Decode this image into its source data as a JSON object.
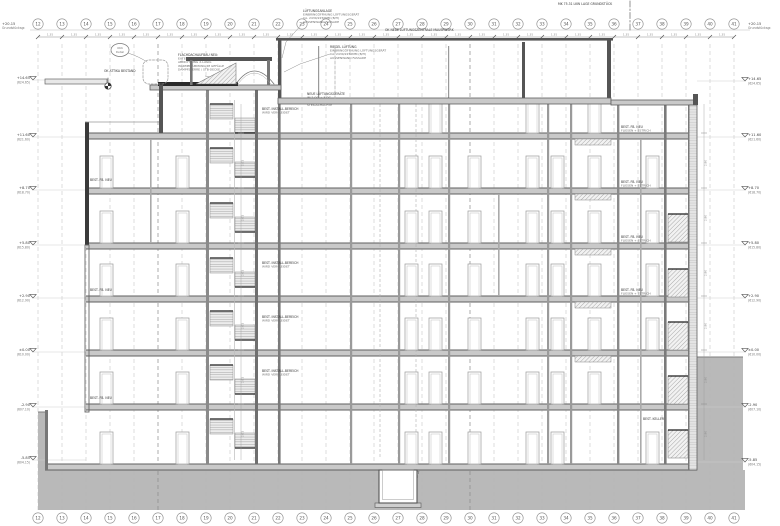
{
  "drawing": {
    "type": "architectural-section",
    "colors": {
      "background": "#ffffff",
      "ink": "#4a4a4a",
      "light_line": "#9a9a9a",
      "grid_dash": "#b6b6b6",
      "grid_dash_strong": "#8c8c8c",
      "slab_fill": "#c9c9c9",
      "slab_edge": "#5f5f5f",
      "ground_fill": "#b9b9b9",
      "dark_fill": "#2e2e2e"
    },
    "grid": {
      "axes": [
        "12",
        "13",
        "14",
        "15",
        "16",
        "17",
        "18",
        "19",
        "20",
        "21",
        "22",
        "23",
        "24",
        "25",
        "26",
        "27",
        "28",
        "29",
        "30",
        "31",
        "32",
        "33",
        "34",
        "35",
        "36",
        "37",
        "38",
        "39",
        "40",
        "41"
      ],
      "strong_axes": [
        "17",
        "30"
      ],
      "x_start": 38,
      "x_spacing": 24,
      "top_bubble_y": 24,
      "bottom_bubble_y": 518,
      "dim_line_y": 37,
      "bay_dim_label": "1.35"
    },
    "levels": {
      "left_x": 30,
      "right_x": 748,
      "left": [
        {
          "y": 80,
          "value": "+14.65",
          "abs": "(624.65)"
        },
        {
          "y": 137,
          "value": "+11.60",
          "abs": "(621.60)"
        },
        {
          "y": 190,
          "value": "+8.70",
          "abs": "(618.70)"
        },
        {
          "y": 245,
          "value": "+5.80",
          "abs": "(615.80)"
        },
        {
          "y": 298,
          "value": "+2.90",
          "abs": "(612.90)"
        },
        {
          "y": 352,
          "value": "±0.00",
          "abs": "(610.00)"
        },
        {
          "y": 407,
          "value": "-2.90",
          "abs": "(607.10)"
        },
        {
          "y": 460,
          "value": "-5.85",
          "abs": "(604.15)"
        }
      ],
      "right": [
        {
          "y": 81,
          "value": "+14.65",
          "abs": "(624.65)"
        },
        {
          "y": 137,
          "value": "+11.60",
          "abs": "(621.60)"
        },
        {
          "y": 190,
          "value": "+8.70",
          "abs": "(618.70)"
        },
        {
          "y": 245,
          "value": "+5.80",
          "abs": "(615.80)"
        },
        {
          "y": 298,
          "value": "+2.90",
          "abs": "(612.90)"
        },
        {
          "y": 352,
          "value": "±0.00",
          "abs": "(610.00)"
        },
        {
          "y": 407,
          "value": "-2.90",
          "abs": "(607.10)"
        },
        {
          "y": 462,
          "value": "-5.85",
          "abs": "(604.15)"
        }
      ],
      "top_left": {
        "y": 25,
        "value": "+20.15",
        "abs": "Grundstücksgr."
      },
      "top_right": {
        "y": 25,
        "value": "+20.15",
        "abs": "Grundstücksgr."
      }
    },
    "structure": {
      "slabs": [
        {
          "x": 86,
          "y": 133,
          "w": 611,
          "h": 6
        },
        {
          "x": 86,
          "y": 188,
          "w": 611,
          "h": 6
        },
        {
          "x": 86,
          "y": 243,
          "w": 611,
          "h": 6
        },
        {
          "x": 86,
          "y": 296,
          "w": 611,
          "h": 6
        },
        {
          "x": 86,
          "y": 350,
          "w": 611,
          "h": 6
        },
        {
          "x": 86,
          "y": 404,
          "w": 611,
          "h": 6
        },
        {
          "x": 45,
          "y": 464,
          "w": 652,
          "h": 6
        }
      ],
      "walls": [
        {
          "x": 150,
          "y1": 139,
          "y2": 243,
          "w": 1.6,
          "tone": "#aaaaaa"
        },
        {
          "x": 206,
          "y1": 90,
          "y2": 464,
          "w": 3,
          "tone": "#8a8a8a"
        },
        {
          "x": 234,
          "y1": 100,
          "y2": 460,
          "w": 0.7,
          "tone": "#bcbcbc"
        },
        {
          "x": 255,
          "y1": 90,
          "y2": 464,
          "w": 3,
          "tone": "#6f6f6f"
        },
        {
          "x": 278,
          "y1": 104,
          "y2": 464,
          "w": 2.6,
          "tone": "#7a7a7a"
        },
        {
          "x": 318,
          "y1": 46,
          "y2": 98,
          "w": 1.2,
          "tone": "#9a9a9a"
        },
        {
          "x": 448,
          "y1": 46,
          "y2": 98,
          "w": 1.2,
          "tone": "#9a9a9a"
        },
        {
          "x": 522,
          "y1": 42,
          "y2": 98,
          "w": 3,
          "tone": "#555555"
        },
        {
          "x": 350,
          "y1": 104,
          "y2": 464,
          "w": 2.2,
          "tone": "#9a9a9a"
        },
        {
          "x": 398,
          "y1": 104,
          "y2": 464,
          "w": 2.2,
          "tone": "#9a9a9a"
        },
        {
          "x": 448,
          "y1": 104,
          "y2": 464,
          "w": 2.2,
          "tone": "#9a9a9a"
        },
        {
          "x": 498,
          "y1": 194,
          "y2": 296,
          "w": 1.6,
          "tone": "#aaaaaa"
        },
        {
          "x": 547,
          "y1": 104,
          "y2": 464,
          "w": 2.2,
          "tone": "#9a9a9a"
        },
        {
          "x": 570,
          "y1": 104,
          "y2": 464,
          "w": 2.2,
          "tone": "#9a9a9a"
        },
        {
          "x": 617,
          "y1": 104,
          "y2": 464,
          "w": 2.4,
          "tone": "#8a8a8a"
        },
        {
          "x": 640,
          "y1": 139,
          "y2": 464,
          "w": 1.6,
          "tone": "#aaaaaa"
        },
        {
          "x": 664,
          "y1": 104,
          "y2": 464,
          "w": 2.6,
          "tone": "#7a7a7a"
        },
        {
          "x": 688,
          "y1": 104,
          "y2": 470,
          "w": 1.4,
          "tone": "#8a8a8a"
        }
      ],
      "shaft_dashed_x": [
        380,
        416
      ],
      "door_rows": [
        {
          "bottom": 133,
          "xs": [
            429,
            526,
            588
          ]
        },
        {
          "bottom": 188,
          "xs": [
            100,
            176,
            405,
            429,
            468,
            526,
            551,
            588,
            646
          ]
        },
        {
          "bottom": 243,
          "xs": [
            100,
            176,
            405,
            429,
            468,
            526,
            551,
            588,
            646
          ]
        },
        {
          "bottom": 296,
          "xs": [
            100,
            176,
            405,
            429,
            468,
            526,
            551,
            588,
            646
          ]
        },
        {
          "bottom": 350,
          "xs": [
            100,
            176,
            405,
            429,
            468,
            526,
            551,
            588,
            646
          ]
        },
        {
          "bottom": 404,
          "xs": [
            100,
            176,
            405,
            429,
            468,
            526,
            551,
            588
          ]
        },
        {
          "bottom": 464,
          "xs": [
            100,
            176,
            405,
            429,
            468,
            526,
            551,
            646
          ]
        }
      ],
      "door": {
        "w": 13,
        "h": 32
      },
      "stair_center_stories": [
        95,
        139,
        194,
        249,
        302,
        356,
        410
      ],
      "stair_right_stories": [
        194,
        249,
        302,
        356,
        410
      ],
      "beam_rows_y": [
        139,
        194,
        249,
        302,
        356
      ],
      "story_dim_left": {
        "x": 241,
        "label": "2.61",
        "stories": [
          139,
          194,
          249,
          302,
          356,
          410
        ]
      },
      "story_dim_right": {
        "x": 704,
        "label": "2.90",
        "stories": [
          139,
          194,
          249,
          302,
          356,
          410
        ]
      }
    },
    "annotations": [
      {
        "x": 303,
        "y": 12,
        "anchor": "start",
        "lines": [
          "LÜFTUNGSANLAGE",
          "EINBRINGÖFFNUNG LÜFTUNGSGERÄT",
          "CA. 2430/2250MM (B/H)",
          "AUSSENWAND FASSADE"
        ],
        "leader": "303,23 286,42 282,58"
      },
      {
        "x": 330,
        "y": 48,
        "anchor": "start",
        "lines": [
          "RIEGEL LÜFTUNG",
          "EINBRINGÖFFNUNG LÜFTUNGSGERÄT",
          "CA. 2430/2250MM (B/H)",
          "AUSSENWAND FASSADE"
        ],
        "leader": "330,54 300,64 284,72"
      },
      {
        "x": 178,
        "y": 56,
        "anchor": "start",
        "lines": [
          "FLACHDACHAUFBAU NEU:",
          "EXTENSIVE BEGRÜNUNG",
          "ABDICHTUNG 2-LAGIG",
          "WÄRMEDÄMMUNG IM GEFÄLLE",
          "DAMPFSPERRE / STB-DECKE"
        ],
        "leader": "205,76 228,80 238,83"
      },
      {
        "x": 385,
        "y": 31,
        "anchor": "start",
        "lines": [
          "OK NEUE LÜFTUNGSZENTRALE MAUERWERK"
        ]
      },
      {
        "x": 558,
        "y": 5,
        "anchor": "start",
        "lines": [
          "MK 75.31 LKW LAGE GRUNDSTÜCK"
        ]
      },
      {
        "x": 104,
        "y": 72,
        "anchor": "start",
        "lines": [
          "OK ATTIKA BESTAND"
        ]
      },
      {
        "x": 262,
        "y": 110,
        "anchor": "start",
        "lines": [
          "BEST. INSTALL.BEREICH",
          "WIRD VERKLEIDET"
        ]
      },
      {
        "x": 307,
        "y": 95,
        "anchor": "start",
        "lines": [
          "NEUE LÜFTUNGSGERÄTE",
          "IM 2.OG + 3.OG",
          "ANSCHLUSS AN BEST.",
          "STEIGSCHÄCHTE"
        ]
      },
      {
        "x": 262,
        "y": 264,
        "anchor": "start",
        "lines": [
          "BEST. INSTALL.BEREICH",
          "WIRD VERKLEIDET"
        ]
      },
      {
        "x": 262,
        "y": 318,
        "anchor": "start",
        "lines": [
          "BEST. INSTALL.BEREICH",
          "WIRD VERKLEIDET"
        ]
      },
      {
        "x": 262,
        "y": 372,
        "anchor": "start",
        "lines": [
          "BEST. INSTALL.BEREICH",
          "WIRD VERKLEIDET"
        ]
      },
      {
        "x": 621,
        "y": 128,
        "anchor": "start",
        "lines": [
          "BEST. FB. NEU",
          "FLIESEN + ESTRICH"
        ]
      },
      {
        "x": 621,
        "y": 183,
        "anchor": "start",
        "lines": [
          "BEST. FB. NEU",
          "FLIESEN + ESTRICH"
        ]
      },
      {
        "x": 621,
        "y": 238,
        "anchor": "start",
        "lines": [
          "BEST. FB. NEU",
          "FLIESEN + ESTRICH"
        ]
      },
      {
        "x": 621,
        "y": 291,
        "anchor": "start",
        "lines": [
          "BEST. FB. NEU",
          "FLIESEN + ESTRICH"
        ]
      },
      {
        "x": 90,
        "y": 181,
        "anchor": "start",
        "lines": [
          "BEST. FB. NEU"
        ]
      },
      {
        "x": 90,
        "y": 291,
        "anchor": "start",
        "lines": [
          "BEST. FB. NEU"
        ]
      },
      {
        "x": 90,
        "y": 399,
        "anchor": "start",
        "lines": [
          "BEST. FB. NEU"
        ]
      },
      {
        "x": 643,
        "y": 420,
        "anchor": "start",
        "lines": [
          "BEST. KELLER"
        ]
      },
      {
        "x": 384,
        "y": 474,
        "anchor": "start",
        "lines": [
          "AUFZUGSUNTERFAHRT",
          "N. STAT. ERFORDERNIS"
        ]
      }
    ],
    "okk_bubble": {
      "cx": 120,
      "cy": 50,
      "lines": [
        "OKK",
        "Detail"
      ]
    },
    "property_line": {
      "x": 630,
      "y1": 1,
      "y2": 32
    }
  }
}
